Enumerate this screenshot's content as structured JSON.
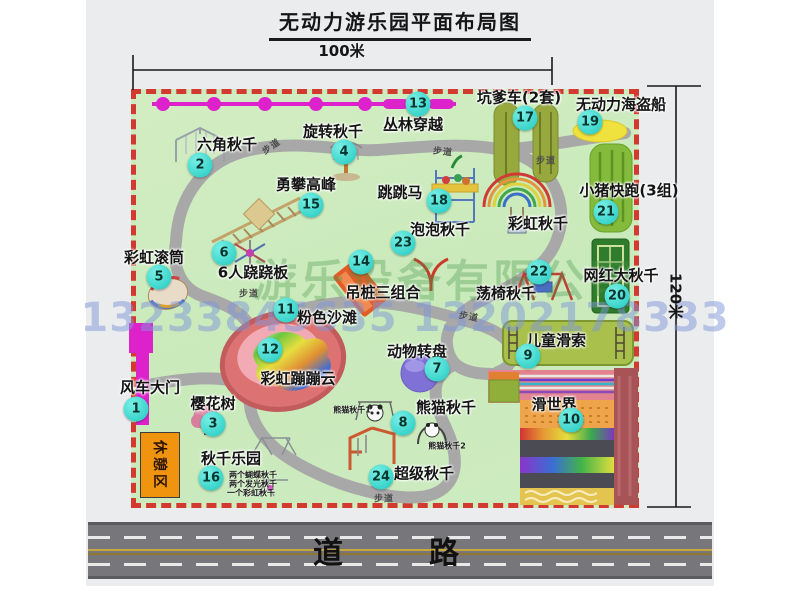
{
  "title": "无动力游乐园平面布局图",
  "dimensions": {
    "width": "100米",
    "height": "120米"
  },
  "road": {
    "label": "道　路"
  },
  "watermark": {
    "company": "游乐设备有限公司",
    "phone": "13233845635 13202178333"
  },
  "rest_area": {
    "label": "休憩区"
  },
  "colors": {
    "map_green": "#cdebc0",
    "border_red": "#d23a30",
    "badge_cyan": "#1fc9c0",
    "zipline_magenta": "#dd22cc",
    "path_gray": "#a8a8a8",
    "road_gray": "#77777b"
  },
  "map": {
    "walkway_text": "步道",
    "walkways": [
      {
        "x": 271,
        "y": 146,
        "rot": -35
      },
      {
        "x": 443,
        "y": 151,
        "rot": 6
      },
      {
        "x": 546,
        "y": 160,
        "rot": 0
      },
      {
        "x": 249,
        "y": 293,
        "rot": 0
      },
      {
        "x": 469,
        "y": 316,
        "rot": 10
      },
      {
        "x": 384,
        "y": 498,
        "rot": 0
      }
    ],
    "attractions": [
      {
        "num": "1",
        "label": "风车大门",
        "lx": 150,
        "ly": 387,
        "bx": 136,
        "by": 409
      },
      {
        "num": "2",
        "label": "六角秋千",
        "lx": 227,
        "ly": 144,
        "bx": 200,
        "by": 165
      },
      {
        "num": "3",
        "label": "樱花树",
        "lx": 213,
        "ly": 403,
        "bx": 213,
        "by": 424
      },
      {
        "num": "4",
        "label": "旋转秋千",
        "lx": 333,
        "ly": 131,
        "bx": 344,
        "by": 152
      },
      {
        "num": "5",
        "label": "彩虹滚筒",
        "lx": 154,
        "ly": 257,
        "bx": 159,
        "by": 277
      },
      {
        "num": "6",
        "label": "6人跷跷板",
        "lx": 253,
        "ly": 272,
        "bx": 224,
        "by": 253
      },
      {
        "num": "7",
        "label": "动物转盘",
        "lx": 417,
        "ly": 351,
        "bx": 437,
        "by": 369
      },
      {
        "num": "8",
        "label": "熊猫秋千",
        "lx": 446,
        "ly": 407,
        "bx": 403,
        "by": 423
      },
      {
        "num": "9",
        "label": "儿童滑索",
        "lx": 556,
        "ly": 340,
        "bx": 528,
        "by": 356
      },
      {
        "num": "10",
        "label": "滑世界",
        "lx": 554,
        "ly": 404,
        "bx": 571,
        "by": 420
      },
      {
        "num": "11",
        "label": "粉色沙滩",
        "lx": 327,
        "ly": 317,
        "bx": 286,
        "by": 310
      },
      {
        "num": "12",
        "label": "彩虹蹦蹦云",
        "lx": 298,
        "ly": 378,
        "bx": 270,
        "by": 350
      },
      {
        "num": "13",
        "label": "丛林穿越",
        "lx": 413,
        "ly": 124,
        "bx": 418,
        "by": 104
      },
      {
        "num": "14",
        "label": "吊桩三组合",
        "lx": 383,
        "ly": 292,
        "bx": 361,
        "by": 262
      },
      {
        "num": "15",
        "label": "勇攀高峰",
        "lx": 306,
        "ly": 184,
        "bx": 311,
        "by": 205
      },
      {
        "num": "16",
        "label": "秋千乐园",
        "lx": 231,
        "ly": 458,
        "bx": 211,
        "by": 478
      },
      {
        "num": "17",
        "label": "坑爹车(2套)",
        "lx": 519,
        "ly": 97,
        "bx": 525,
        "by": 118
      },
      {
        "num": "18",
        "label": "跳跳马",
        "lx": 400,
        "ly": 192,
        "bx": 439,
        "by": 201
      },
      {
        "num": "19",
        "label": "无动力海盗船",
        "lx": 621,
        "ly": 104,
        "bx": 590,
        "by": 122
      },
      {
        "num": "20",
        "label": "网红大秋千",
        "lx": 621,
        "ly": 275,
        "bx": 617,
        "by": 296
      },
      {
        "num": "21",
        "label": "小猪快跑(3组)",
        "lx": 629,
        "ly": 190,
        "bx": 606,
        "by": 212
      },
      {
        "num": "22",
        "label": "荡椅秋千",
        "lx": 506,
        "ly": 293,
        "bx": 539,
        "by": 272
      },
      {
        "num": "23",
        "label": "泡泡秋千",
        "lx": 440,
        "ly": 229,
        "bx": 403,
        "by": 243
      },
      {
        "num": "24",
        "label": "超级秋千",
        "lx": 424,
        "ly": 473,
        "bx": 381,
        "by": 477
      },
      {
        "num": "",
        "label": "彩虹秋千",
        "lx": 538,
        "ly": 223,
        "bx": 0,
        "by": 0
      }
    ],
    "sublabels": [
      {
        "label": "熊猫秋千1",
        "x": 352,
        "y": 410
      },
      {
        "label": "熊猫秋千2",
        "x": 447,
        "y": 446
      },
      {
        "label": "两个蝴蝶秋千",
        "x": 253,
        "y": 475
      },
      {
        "label": "两个发光秋千",
        "x": 253,
        "y": 484
      },
      {
        "label": "一个彩虹秋千",
        "x": 251,
        "y": 493
      }
    ]
  }
}
